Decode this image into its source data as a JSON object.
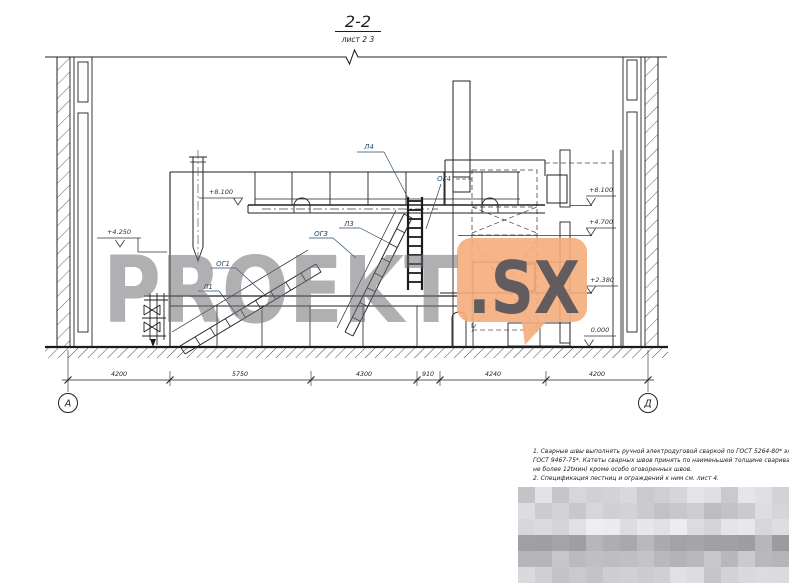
{
  "title": {
    "section_name": "2-2",
    "sheet_ref": "лист 2 3"
  },
  "drawing": {
    "ladder_labels": {
      "l1": "Л1",
      "l3": "Л3",
      "l4": "Л4",
      "og1": "ОГ1",
      "og3": "ОГ3",
      "og4": "ОГ4"
    },
    "elevations": {
      "left_mid": "+4.250",
      "left_top": "+8.100",
      "right_top": "+8.100",
      "right_upper": "+4.700",
      "right_mid": "+2.380",
      "right_zero": "0.000"
    },
    "dimensions": [
      "4200",
      "5750",
      "4300",
      "910",
      "4240",
      "4200"
    ],
    "axes": {
      "left": "А",
      "right": "Д"
    }
  },
  "watermark": {
    "brand": "PROEKT",
    "suffix": ".SX",
    "bubble_color": "#f5ad7c",
    "brand_color": "#707074",
    "suffix_color": "#55555a"
  },
  "notes": {
    "lines": [
      "1. Сварные швы выполнять ручной электродуговой сваркой по ГОСТ 5264-80* электродами Э42",
      "ГОСТ 9467-75*. Катеты сварных швов принять по наименьшей толщине свариваемых деталей (но",
      "не более 12tмин) кроме особо оговоренных швов.",
      "2. Спецификация лестниц и ограждений к ним см. лист 4."
    ]
  }
}
